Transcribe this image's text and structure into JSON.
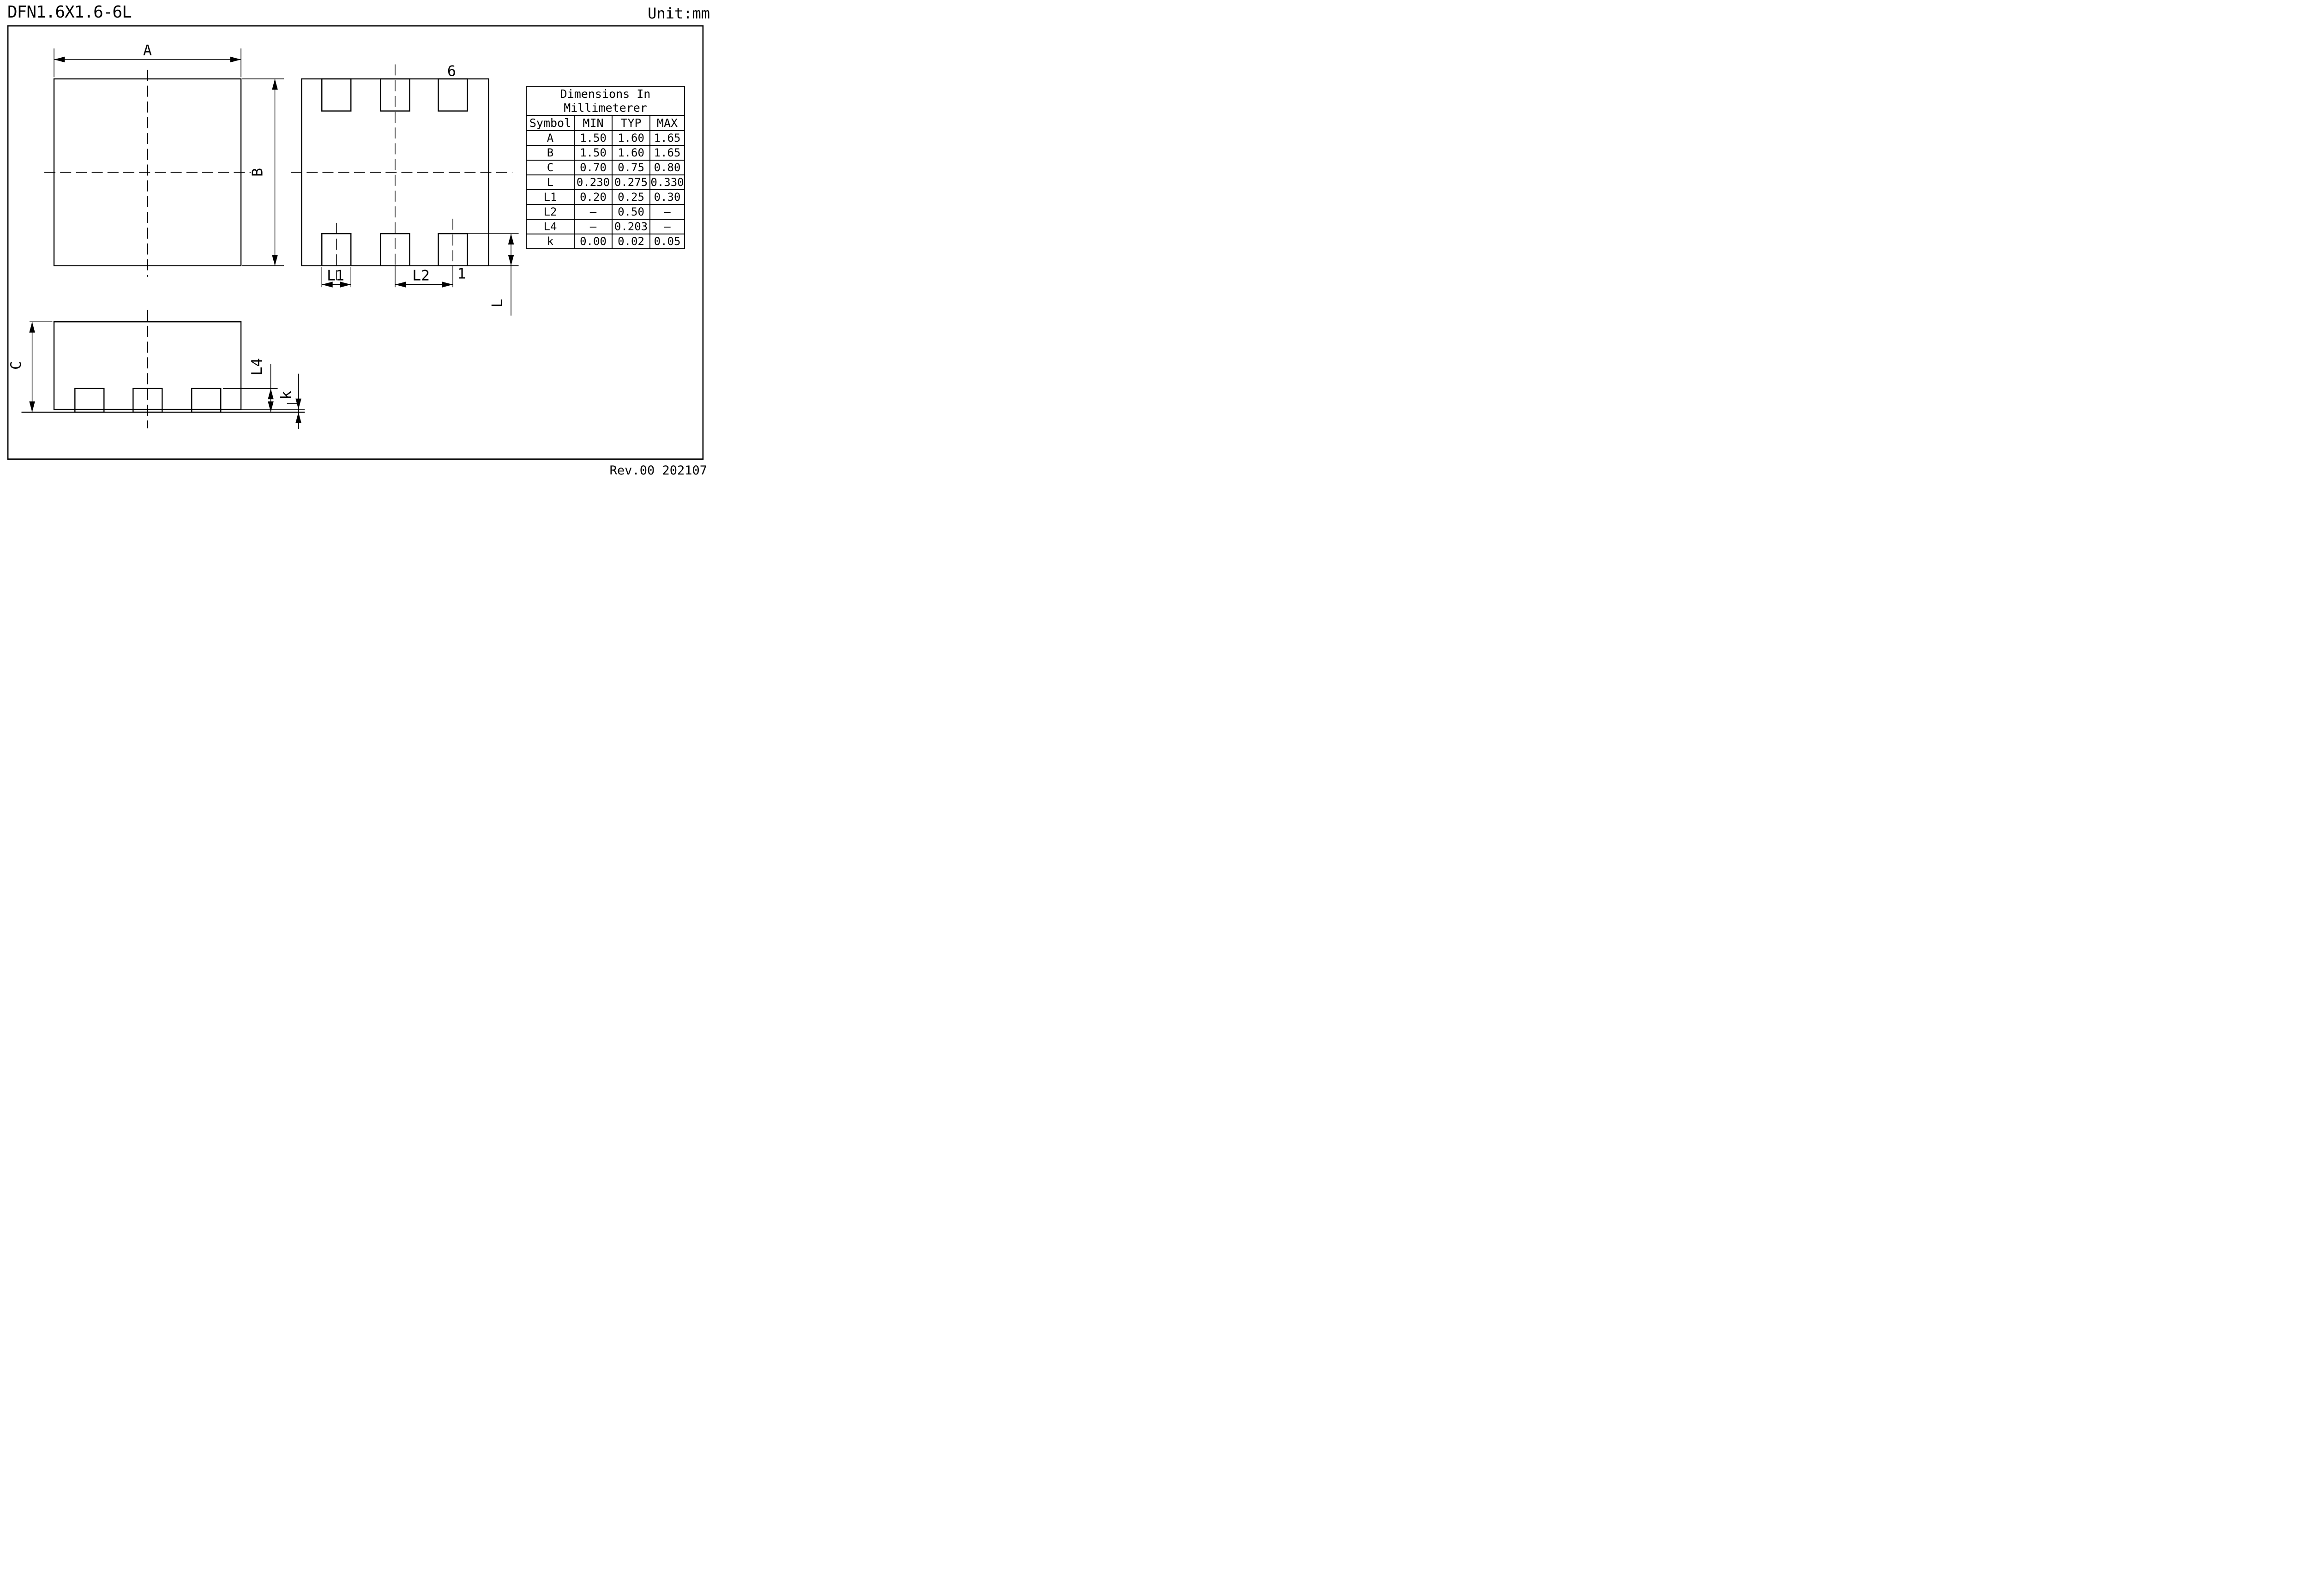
{
  "page": {
    "title": "DFN1.6X1.6-6L",
    "unit": "Unit:mm",
    "revision": "Rev.00  202107"
  },
  "table": {
    "title": "Dimensions  In\nMillimeterer",
    "columns": [
      "Symbol",
      "MIN",
      "TYP",
      "MAX"
    ],
    "rows": [
      {
        "symbol": "A",
        "min": "1.50",
        "typ": "1.60",
        "max": "1.65"
      },
      {
        "symbol": "B",
        "min": "1.50",
        "typ": "1.60",
        "max": "1.65"
      },
      {
        "symbol": "C",
        "min": "0.70",
        "typ": "0.75",
        "max": "0.80"
      },
      {
        "symbol": "L",
        "min": "0.230",
        "typ": "0.275",
        "max": "0.330"
      },
      {
        "symbol": "L1",
        "min": "0.20",
        "typ": "0.25",
        "max": "0.30"
      },
      {
        "symbol": "L2",
        "min": "–",
        "typ": "0.50",
        "max": "–"
      },
      {
        "symbol": "L4",
        "min": "–",
        "typ": "0.203",
        "max": "–"
      },
      {
        "symbol": "k",
        "min": "0.00",
        "typ": "0.02",
        "max": "0.05"
      }
    ]
  },
  "views": {
    "top": {
      "dim_a": "A",
      "dim_b": "B"
    },
    "bottom": {
      "pin_6": "6",
      "pin_1": "1",
      "dim_l1": "L1",
      "dim_l2": "L2",
      "dim_l": "L"
    },
    "side": {
      "dim_c": "C",
      "dim_l4": "L4",
      "dim_k": "k"
    }
  },
  "colors": {
    "ink": "#000000",
    "paper": "#ffffff"
  }
}
